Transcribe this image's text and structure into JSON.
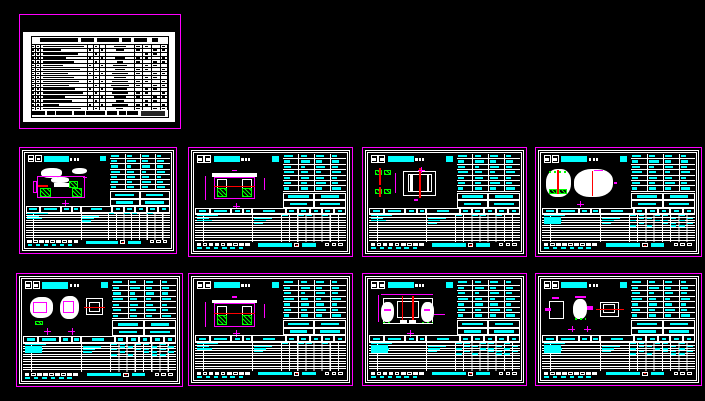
{
  "canvas": {
    "background": "#000000"
  },
  "palette": {
    "sheet_border": "#ff00ff",
    "line_work": "#ffffff",
    "annotation_text": "#00ffff",
    "hatch": "#00ff00",
    "axis_line": "#ff0000",
    "paper": "#ffffff",
    "table_ink": "#000000"
  },
  "sheets": [
    {
      "id": "sheet-1-drawing-list",
      "variant": "drawing-list",
      "table_style": "none"
    },
    {
      "id": "sheet-2",
      "variant": "abutment-plan",
      "table_style": "std"
    },
    {
      "id": "sheet-3",
      "variant": "abutment-elevation",
      "table_style": "std"
    },
    {
      "id": "sheet-4",
      "variant": "pier-plan-elevation",
      "table_style": "std"
    },
    {
      "id": "sheet-5",
      "variant": "pier-elevation-clouds",
      "table_style": "heavy"
    },
    {
      "id": "sheet-6",
      "variant": "bearing-plan",
      "table_style": "heavy"
    },
    {
      "id": "sheet-7",
      "variant": "abutment-elevation",
      "table_style": "std"
    },
    {
      "id": "sheet-8",
      "variant": "portal-elevation",
      "table_style": "heavy"
    },
    {
      "id": "sheet-9",
      "variant": "bearing-detail",
      "table_style": "heavy"
    }
  ],
  "placeholders": {
    "title_table": {
      "header": [
        [
          6,
          28
        ],
        [
          36,
          10
        ],
        [
          48,
          16
        ],
        [
          66,
          7
        ],
        [
          75,
          10
        ],
        [
          88,
          5
        ]
      ],
      "rows": [
        [
          92,
          45
        ],
        [
          40,
          30
        ],
        [
          78,
          0
        ],
        [
          52,
          35
        ],
        [
          70,
          22
        ],
        [
          46,
          50
        ],
        [
          82,
          38
        ],
        [
          55,
          60
        ],
        [
          68,
          42
        ],
        [
          80,
          55
        ],
        [
          58,
          65
        ],
        [
          72,
          50
        ],
        [
          88,
          60
        ],
        [
          50,
          45
        ],
        [
          64,
          30
        ],
        [
          36,
          55
        ],
        [
          85,
          25
        ]
      ],
      "footer": [
        [
          0,
          10
        ],
        [
          11,
          6
        ],
        [
          18,
          12
        ],
        [
          31,
          8
        ],
        [
          40,
          14
        ],
        [
          55,
          8
        ],
        [
          64,
          5
        ],
        [
          70,
          8
        ]
      ]
    },
    "spec_rows": [
      [
        70,
        50,
        60,
        40
      ],
      [
        50,
        80,
        50,
        60
      ],
      [
        60,
        40,
        70,
        50
      ],
      [
        80,
        60,
        40,
        70
      ],
      [
        50,
        70,
        60,
        40
      ],
      [
        60,
        50,
        80,
        50
      ],
      [
        40,
        60,
        50,
        70
      ]
    ],
    "spec_boxes": [
      [
        80,
        70
      ],
      [
        70,
        80
      ]
    ],
    "col_headers": [
      60,
      70,
      50,
      60,
      40,
      50,
      50,
      40,
      50,
      40
    ],
    "bottom_std": [
      {
        "bars": [
          [
            1,
            14
          ]
        ],
        "rticks": [
          0,
          2,
          3,
          5
        ]
      },
      {
        "bars": [
          [
            1,
            8
          ],
          [
            39,
            12
          ]
        ],
        "rticks": []
      },
      {
        "bars": [
          [
            1,
            10
          ],
          [
            39,
            8
          ]
        ],
        "rticks": []
      },
      {
        "bars": [
          [
            39,
            6
          ]
        ],
        "rticks": []
      }
    ],
    "bottom_heavy": [
      {
        "bars": [
          [
            1,
            14
          ]
        ],
        "rticks": [
          0,
          1,
          3,
          4,
          6
        ]
      },
      {
        "bars": [
          [
            1,
            8
          ],
          [
            39,
            12
          ]
        ],
        "rticks": [
          1,
          2,
          5,
          7
        ]
      },
      {
        "bars": [
          [
            1,
            12
          ],
          [
            39,
            8
          ]
        ],
        "rticks": [
          0,
          3,
          4,
          6
        ],
        "block": true
      },
      {
        "bars": [
          [
            39,
            6
          ]
        ],
        "rticks": [
          1,
          4,
          5,
          7
        ]
      },
      {
        "bars": [],
        "rticks": [
          0,
          2,
          5,
          6
        ]
      }
    ],
    "strip_boxes": [
      1,
      0,
      1,
      1,
      0,
      1,
      0,
      1,
      1
    ],
    "strip_dashes": 6
  },
  "drawings": {
    "abutment-plan": [
      {
        "t": "cloud",
        "x": 18,
        "y": 8,
        "w": 26,
        "h": 24
      },
      {
        "t": "cloud",
        "x": 30,
        "y": 30,
        "w": 22,
        "h": 14
      },
      {
        "t": "cloud",
        "x": 56,
        "y": 8,
        "w": 18,
        "h": 16
      },
      {
        "t": "m",
        "x": 14,
        "y": 28,
        "w": 58,
        "h": 52
      },
      {
        "t": "wf",
        "x": 34,
        "y": 44,
        "w": 24,
        "h": 10
      },
      {
        "t": "h",
        "x": 17,
        "y": 56,
        "w": 13,
        "h": 22
      },
      {
        "t": "h",
        "x": 52,
        "y": 40,
        "w": 11,
        "h": 16
      },
      {
        "t": "h",
        "x": 56,
        "y": 58,
        "w": 12,
        "h": 20
      },
      {
        "t": "r",
        "x": 15,
        "y": 50,
        "w": 12,
        "h": 4
      },
      {
        "t": "m",
        "x": 8,
        "y": 40,
        "w": 6,
        "h": 28
      },
      {
        "t": "x",
        "x": 44,
        "y": 86,
        "w": 8
      },
      {
        "t": "mf",
        "x": 70,
        "y": 30,
        "w": 4,
        "h": 4
      }
    ],
    "abutment-elevation": [
      {
        "t": "wf",
        "x": 20,
        "y": 20,
        "w": 52,
        "h": 8
      },
      {
        "t": "m",
        "x": 22,
        "y": 28,
        "w": 48,
        "h": 52
      },
      {
        "t": "w",
        "x": 26,
        "y": 34,
        "w": 11,
        "h": 42
      },
      {
        "t": "w",
        "x": 55,
        "y": 34,
        "w": 11,
        "h": 42
      },
      {
        "t": "h",
        "x": 26,
        "y": 54,
        "w": 11,
        "h": 22
      },
      {
        "t": "h",
        "x": 55,
        "y": 54,
        "w": 11,
        "h": 22
      },
      {
        "t": "r",
        "x": 22,
        "y": 50,
        "w": 48,
        "h": 3
      },
      {
        "t": "dv",
        "x": 12,
        "y": 26,
        "h": 56
      },
      {
        "t": "dv",
        "x": 80,
        "y": 30,
        "h": 30
      },
      {
        "t": "x",
        "x": 44,
        "y": 88,
        "w": 8
      },
      {
        "t": "mf",
        "x": 43,
        "y": 12,
        "w": 6,
        "h": 3
      }
    ],
    "pier-plan-elevation": [
      {
        "t": "h",
        "x": 7,
        "y": 12,
        "w": 8,
        "h": 12
      },
      {
        "t": "h",
        "x": 18,
        "y": 12,
        "w": 8,
        "h": 12
      },
      {
        "t": "r",
        "x": 12,
        "y": 8,
        "w": 2,
        "h": 40
      },
      {
        "t": "h",
        "x": 7,
        "y": 56,
        "w": 8,
        "h": 12
      },
      {
        "t": "h",
        "x": 18,
        "y": 56,
        "w": 8,
        "h": 12
      },
      {
        "t": "r",
        "x": 12,
        "y": 52,
        "w": 2,
        "h": 24
      },
      {
        "t": "dv",
        "x": 30,
        "y": 20,
        "h": 45
      },
      {
        "t": "w",
        "x": 40,
        "y": 14,
        "w": 38,
        "h": 58
      },
      {
        "t": "w",
        "x": 45,
        "y": 22,
        "w": 28,
        "h": 42
      },
      {
        "t": "wf",
        "x": 48,
        "y": 22,
        "w": 3,
        "h": 42
      },
      {
        "t": "wf",
        "x": 67,
        "y": 22,
        "w": 3,
        "h": 42
      },
      {
        "t": "r",
        "x": 58,
        "y": 8,
        "w": 2,
        "h": 70
      },
      {
        "t": "x",
        "x": 57,
        "y": 5,
        "w": 8
      },
      {
        "t": "mf",
        "x": 52,
        "y": 80,
        "w": 5,
        "h": 4
      }
    ],
    "pier-elevation-clouds": [
      {
        "t": "cloud",
        "x": 5,
        "y": 10,
        "w": 28,
        "h": 66
      },
      {
        "t": "hd",
        "x": 8,
        "y": 16,
        "w": 22,
        "h": 4
      },
      {
        "t": "wf",
        "x": 8,
        "y": 26,
        "w": 22,
        "h": 2
      },
      {
        "t": "h",
        "x": 8,
        "y": 56,
        "w": 9,
        "h": 12
      },
      {
        "t": "h",
        "x": 20,
        "y": 56,
        "w": 9,
        "h": 12
      },
      {
        "t": "r",
        "x": 17,
        "y": 12,
        "w": 2,
        "h": 56
      },
      {
        "t": "cloud",
        "x": 37,
        "y": 10,
        "w": 44,
        "h": 66
      },
      {
        "t": "w",
        "x": 42,
        "y": 20,
        "w": 33,
        "h": 46
      },
      {
        "t": "wf",
        "x": 46,
        "y": 20,
        "w": 3,
        "h": 46
      },
      {
        "t": "wf",
        "x": 68,
        "y": 20,
        "w": 3,
        "h": 46
      },
      {
        "t": "r",
        "x": 57,
        "y": 14,
        "w": 2,
        "h": 58
      },
      {
        "t": "mf",
        "x": 60,
        "y": 12,
        "w": 10,
        "h": 4
      },
      {
        "t": "x",
        "x": 40,
        "y": 84,
        "w": 8
      },
      {
        "t": "mf",
        "x": 82,
        "y": 40,
        "w": 4,
        "h": 6
      }
    ],
    "bearing-plan": [
      {
        "t": "cloud",
        "x": 8,
        "y": 14,
        "w": 26,
        "h": 46
      },
      {
        "t": "m",
        "x": 12,
        "y": 24,
        "w": 16,
        "h": 26
      },
      {
        "t": "cloud",
        "x": 42,
        "y": 10,
        "w": 22,
        "h": 52
      },
      {
        "t": "m",
        "x": 46,
        "y": 22,
        "w": 13,
        "h": 28
      },
      {
        "t": "w",
        "x": 72,
        "y": 16,
        "w": 20,
        "h": 38
      },
      {
        "t": "w",
        "x": 76,
        "y": 24,
        "w": 12,
        "h": 22
      },
      {
        "t": "r",
        "x": 70,
        "y": 36,
        "w": 24,
        "h": 2
      },
      {
        "t": "h",
        "x": 14,
        "y": 66,
        "w": 9,
        "h": 10
      },
      {
        "t": "x",
        "x": 24,
        "y": 82,
        "w": 8
      },
      {
        "t": "x",
        "x": 52,
        "y": 82,
        "w": 8
      }
    ],
    "portal-elevation": [
      {
        "t": "dh",
        "x": 14,
        "y": 8,
        "w": 60
      },
      {
        "t": "dv",
        "x": 10,
        "y": 10,
        "h": 60
      },
      {
        "t": "w",
        "x": 16,
        "y": 16,
        "w": 58,
        "h": 58
      },
      {
        "t": "cloud",
        "x": 14,
        "y": 24,
        "w": 15,
        "h": 46
      },
      {
        "t": "cloud",
        "x": 60,
        "y": 24,
        "w": 15,
        "h": 46
      },
      {
        "t": "w",
        "x": 32,
        "y": 22,
        "w": 26,
        "h": 40
      },
      {
        "t": "r",
        "x": 38,
        "y": 12,
        "w": 2,
        "h": 60
      },
      {
        "t": "r",
        "x": 50,
        "y": 12,
        "w": 2,
        "h": 60
      },
      {
        "t": "mf",
        "x": 18,
        "y": 40,
        "w": 7,
        "h": 6
      },
      {
        "t": "mf",
        "x": 64,
        "y": 40,
        "w": 7,
        "h": 6
      },
      {
        "t": "hd",
        "x": 16,
        "y": 70,
        "w": 12,
        "h": 3
      },
      {
        "t": "hd",
        "x": 62,
        "y": 70,
        "w": 12,
        "h": 3
      },
      {
        "t": "wf",
        "x": 36,
        "y": 66,
        "w": 8,
        "h": 8
      },
      {
        "t": "wf",
        "x": 47,
        "y": 66,
        "w": 8,
        "h": 8
      },
      {
        "t": "x",
        "x": 44,
        "y": 88,
        "w": 8
      },
      {
        "t": "mf",
        "x": 76,
        "y": 52,
        "w": 12,
        "h": 2
      }
    ],
    "bearing-detail": [
      {
        "t": "w",
        "x": 8,
        "y": 22,
        "w": 17,
        "h": 42
      },
      {
        "t": "mf",
        "x": 12,
        "y": 14,
        "w": 8,
        "h": 5
      },
      {
        "t": "mf",
        "x": 4,
        "y": 38,
        "w": 6,
        "h": 8
      },
      {
        "t": "cloud",
        "x": 36,
        "y": 18,
        "w": 16,
        "h": 46
      },
      {
        "t": "mf",
        "x": 38,
        "y": 12,
        "w": 12,
        "h": 5
      },
      {
        "t": "mf",
        "x": 52,
        "y": 34,
        "w": 6,
        "h": 8
      },
      {
        "t": "hd",
        "x": 38,
        "y": 62,
        "w": 12,
        "h": 3
      },
      {
        "t": "w",
        "x": 66,
        "y": 24,
        "w": 22,
        "h": 34
      },
      {
        "t": "w",
        "x": 70,
        "y": 30,
        "w": 14,
        "h": 20
      },
      {
        "t": "r",
        "x": 62,
        "y": 40,
        "w": 32,
        "h": 2
      },
      {
        "t": "x",
        "x": 30,
        "y": 78,
        "w": 8
      },
      {
        "t": "x",
        "x": 48,
        "y": 78,
        "w": 8
      }
    ]
  }
}
